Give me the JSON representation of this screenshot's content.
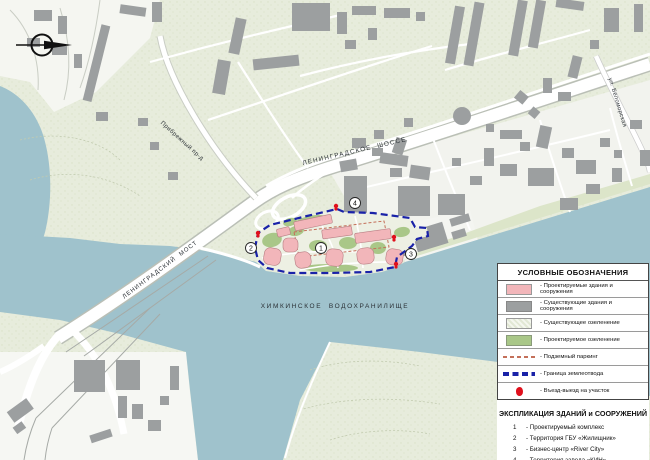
{
  "colors": {
    "land": "#e7ecdc",
    "water": "#9fc2cc",
    "building": "#9c9fa0",
    "road": "#ffffff",
    "sitePink": "#f2b6ba",
    "siteGreen": "#a9c788",
    "boundBlue": "#1a22a8",
    "parkRed": "#c4705a",
    "markRed": "#e0101c"
  },
  "map": {
    "labels": {
      "reservoir": "ХИМКИНСКОЕ  ВОДОХРАНИЛИЩЕ",
      "highway": "ЛЕНИНГРАДСКОЕ  ШОССЕ",
      "bridge": "ЛЕНИНГРАДСКИЙ  МОСТ",
      "proezd": "Прибрежный пр-д",
      "street": "ул. Беломорская"
    },
    "site_numbers": [
      {
        "n": "1"
      },
      {
        "n": "2"
      },
      {
        "n": "3"
      },
      {
        "n": "4"
      }
    ]
  },
  "legend": {
    "title": "УСЛОВНЫЕ ОБОЗНАЧЕНИЯ",
    "items": [
      {
        "swatch": "pink-fill",
        "label": "- Проектируемые здания и сооружения"
      },
      {
        "swatch": "gray-fill",
        "label": "- Существующие здания и сооружения"
      },
      {
        "swatch": "hatch-fill",
        "label": "- Существующее озеленение"
      },
      {
        "swatch": "green-fill",
        "label": "- Проектируемое озеленение"
      },
      {
        "swatch": "red-dash",
        "label": "- Подземный паркинг"
      },
      {
        "swatch": "blue-dash",
        "label": "- Граница землеотвода"
      },
      {
        "swatch": "red-dot",
        "label": "- Въезд-выезд на участок"
      }
    ]
  },
  "explication": {
    "title": "ЭКСПЛИКАЦИЯ ЗДАНИЙ и СООРУЖЕНИЙ",
    "items": [
      {
        "num": "1",
        "label": "- Проектируемый комплекс"
      },
      {
        "num": "2",
        "label": "- Территория ГБУ «Жилищник»"
      },
      {
        "num": "3",
        "label": "- Бизнес-центр «River City»"
      },
      {
        "num": "4",
        "label": "- Территория завода «КИН»"
      }
    ]
  }
}
